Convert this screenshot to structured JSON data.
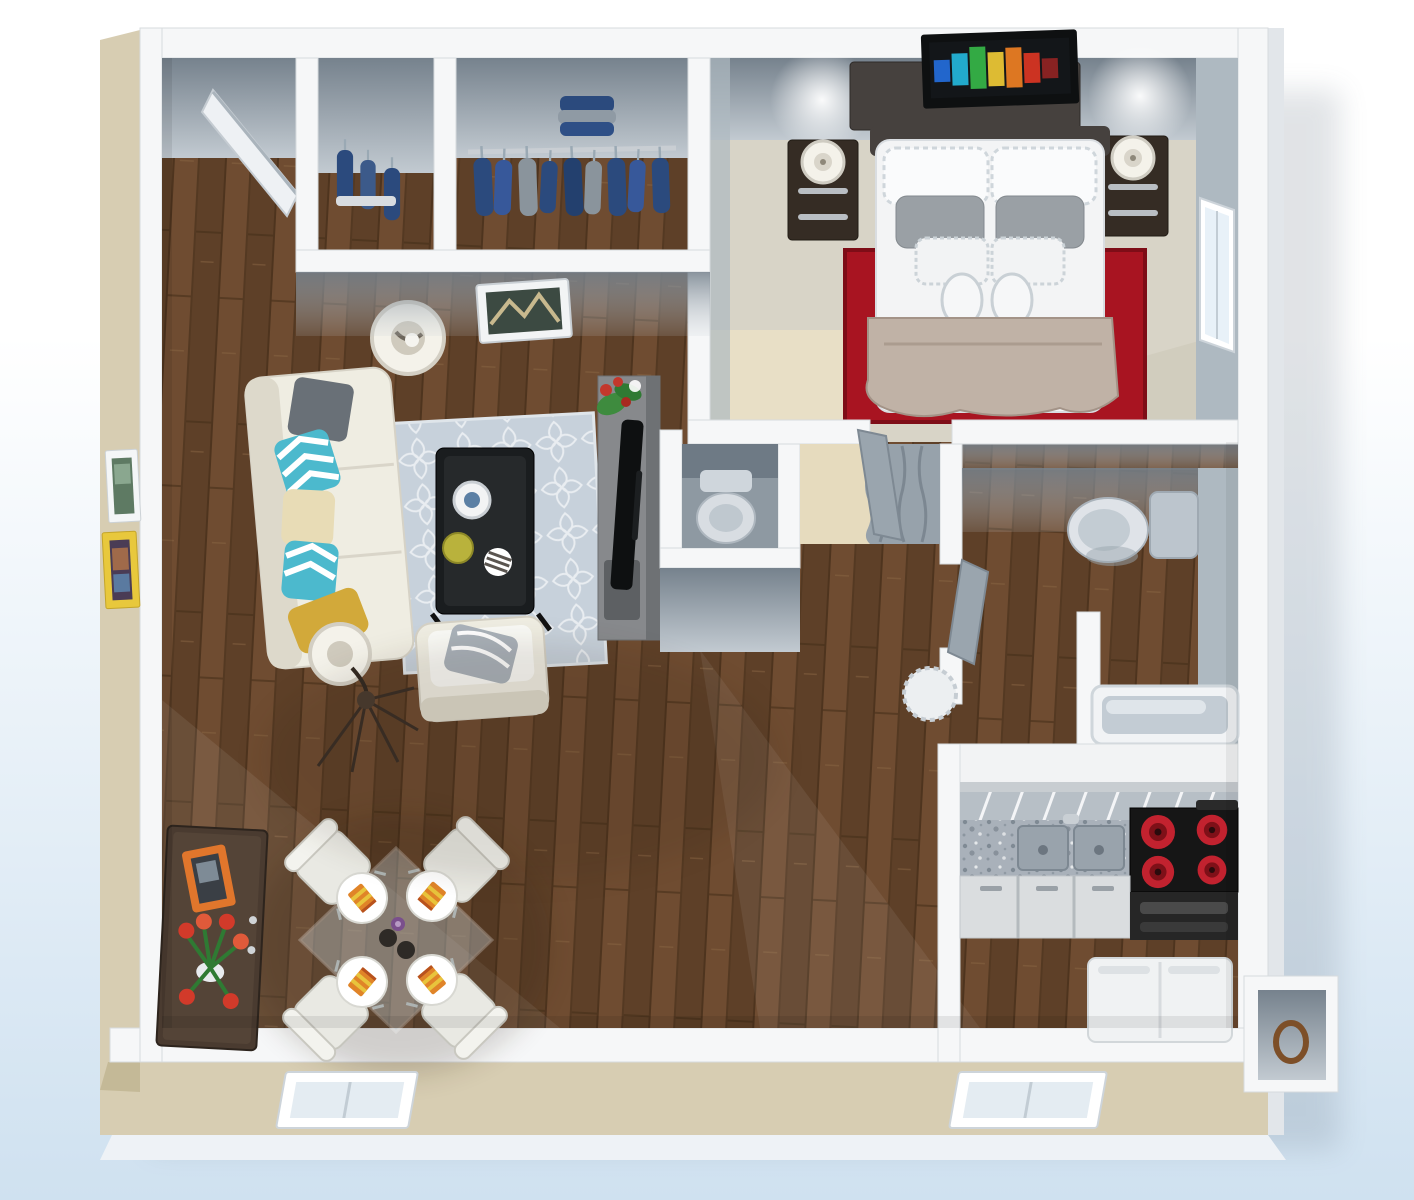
{
  "meta": {
    "description": "3D rendered top-down floor plan of a one-bedroom apartment",
    "visible_text": []
  },
  "palette": {
    "bg-top": "#ffffff",
    "bg-bottom": "#cfe1f0",
    "wall-white": "#f6f7f8",
    "wall-edge": "#d7dbde",
    "wall-face-dark": "#76828d",
    "wall-face-light": "#c2cad1",
    "wall-face-side": "#aeb9c1",
    "exterior-beige": "#d7cdb2",
    "exterior-beige-dark": "#c4b997",
    "skirt-white": "#eef2f6",
    "wood-base": "#6f4c31",
    "wood-dark": "#5e4028",
    "bedroom-floor": "#d8d4c7",
    "bedroom-floor-beige": "#e8dfc6",
    "rug-red": "#a81421",
    "rug-red-dark": "#7e0d17",
    "area-rug": "#c7d1db",
    "sofa-white": "#efede2",
    "sofa-shade": "#ddd9cb",
    "pillow-teal": "#4cb9cd",
    "pillow-gray": "#697077",
    "pillow-cream": "#e8dcb6",
    "pillow-yellow": "#d2a93a",
    "table-dark": "#1a1d1f",
    "tv-black": "#0e1011",
    "tv-stand-gray": "#87898c",
    "tv-stand-side": "#6e7174",
    "plant-green": "#3e8b3e",
    "plant-red": "#c3372c",
    "lamp-shade": "#f4f2ea",
    "chair-white": "#e9e9e3",
    "napkin-orange": "#e08428",
    "napkin-yellow": "#e8c43c",
    "sideboard-wood": "#4a3b30",
    "sideboard-top": "#5c4c3e",
    "frame-orange": "#e0762c",
    "frame-yellow": "#e8c83c",
    "tulip-red": "#d23a2a",
    "granite": "#a9b1ba",
    "granite-dark": "#7f8a94",
    "counter-white": "#f2f3f4",
    "counter-edge": "#b7bfc6",
    "cabinet-front": "#dadddf",
    "stove-black": "#161616",
    "burner-red": "#c2222f",
    "fixture-white": "#dfe3e8",
    "fixture-gray": "#bcc5cd",
    "curtain-gray": "#97a2ab",
    "alcove-beige": "#e6dbbe",
    "closet-navy": "#2b4a7d",
    "closet-gray": "#8a949c",
    "door-white": "#eef1f4",
    "glass-blue": "#cfe0e8"
  },
  "inventory": {
    "rooms": [
      {
        "id": "entry",
        "label": "entry"
      },
      {
        "id": "closet-small",
        "label": "small closet"
      },
      {
        "id": "closet-walkin",
        "label": "walk-in closet"
      },
      {
        "id": "living-room",
        "label": "living room"
      },
      {
        "id": "dining-area",
        "label": "dining area"
      },
      {
        "id": "bedroom",
        "label": "bedroom"
      },
      {
        "id": "water-closet",
        "label": "water closet"
      },
      {
        "id": "hallway",
        "label": "hallway"
      },
      {
        "id": "bathroom",
        "label": "bathroom"
      },
      {
        "id": "kitchen",
        "label": "kitchen"
      },
      {
        "id": "utility-area",
        "label": "utility area"
      },
      {
        "id": "storage-nook",
        "label": "storage nook"
      }
    ],
    "furniture": [
      "entry-door",
      "hanging-clothes",
      "closet-rod",
      "wall-art-hallway",
      "wall-art-white",
      "wall-art-yellow",
      "sofa",
      "throw-pillows",
      "floor-lamp",
      "coffee-table",
      "trellis-rug",
      "armchair",
      "wire-side-table",
      "tv-stand",
      "flatscreen-tv",
      "houseplant",
      "dining-table",
      "dining-chair",
      "place-setting",
      "sideboard",
      "tulip-bouquet",
      "picture-frame",
      "bed",
      "headboard",
      "nightstand",
      "table-lamp",
      "dresser",
      "bedroom-tv",
      "red-rug",
      "bedroom-window",
      "toilet",
      "curtain-closet",
      "bathtub",
      "bath-mat",
      "breakfast-bar",
      "granite-counter",
      "double-sink",
      "cooktop",
      "cabinets",
      "washer",
      "storage-ring",
      "bottom-window"
    ]
  }
}
